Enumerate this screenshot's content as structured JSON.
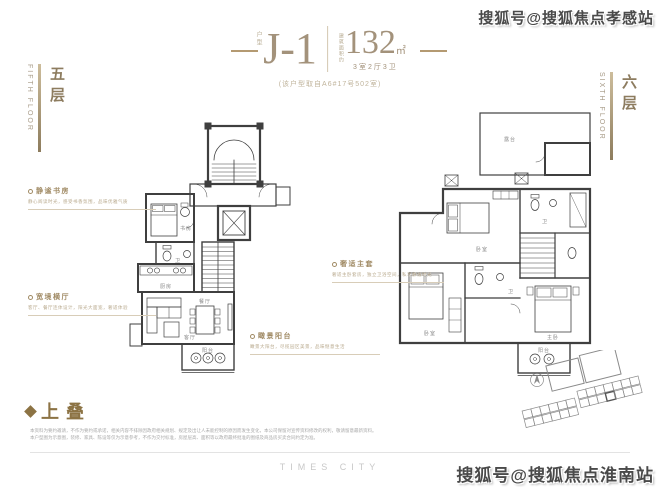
{
  "colors": {
    "accent": "#a8906c",
    "line": "#3f3f3f",
    "gold_bar": "#8d7c5d"
  },
  "watermarks": {
    "top": "搜狐号@搜狐焦点孝感站",
    "bottom": "搜狐号@搜狐焦点淮南站"
  },
  "header": {
    "unit_prefix": "户型",
    "unit_code": "J-1",
    "area_note": "建筑面积约",
    "area_value": "132",
    "area_unit": "㎡",
    "rooms_summary": "3室2厅3卫",
    "source_note": "(该户型取自A6#17号502室)"
  },
  "floors": {
    "left": {
      "cn": "五层",
      "en": "FIFTH FLOOR"
    },
    "right": {
      "cn": "六层",
      "en": "SIXTH FLOOR"
    }
  },
  "annotations": {
    "study": {
      "title": "静谧书房",
      "desc": "静心阅读时光，感受书香氛围，品味优雅气质"
    },
    "hall": {
      "title": "宽境横厅",
      "desc": "客厅、餐厅连体设计，阳光大面宽，奢适体验"
    },
    "view_balcony": {
      "title": "瞰景阳台",
      "desc": "瞰景大阳台，尽揽园区美景，品味惬意生活"
    },
    "master_suite": {
      "title": "奢适主套",
      "desc": "奢适主卧套房，独立卫浴空间，私享静谧时光"
    }
  },
  "rooms": {
    "left": {
      "study": "书房",
      "bath": "卫",
      "kitchen": "厨房",
      "living": "客厅",
      "dining": "餐厅",
      "balcony": "阳台"
    },
    "right": {
      "terrace": "露台",
      "bedroom_a": "卧室",
      "bath_a": "卫",
      "bedroom_b": "卧室",
      "bath_b": "卫",
      "master": "主卧",
      "balcony": "阳台"
    }
  },
  "section": {
    "label": "上叠"
  },
  "footer": {
    "disclaimer_line1": "本资料为要约邀请，不作为要约或承诺，相关内容不排除因政府相关规划、规定及出让人未能控制的原因而发生变化，本公司保留对宣传资料修改的权利，敬请留意最新资料。",
    "disclaimer_line2": "本户型图为示意图，装修、家具、陈设等仅为示意参考，不作为交付标准，房屋层高、面积等以政府最终批准的图纸及商品房买卖合同约定为准。",
    "brand": "TIMES CITY"
  }
}
